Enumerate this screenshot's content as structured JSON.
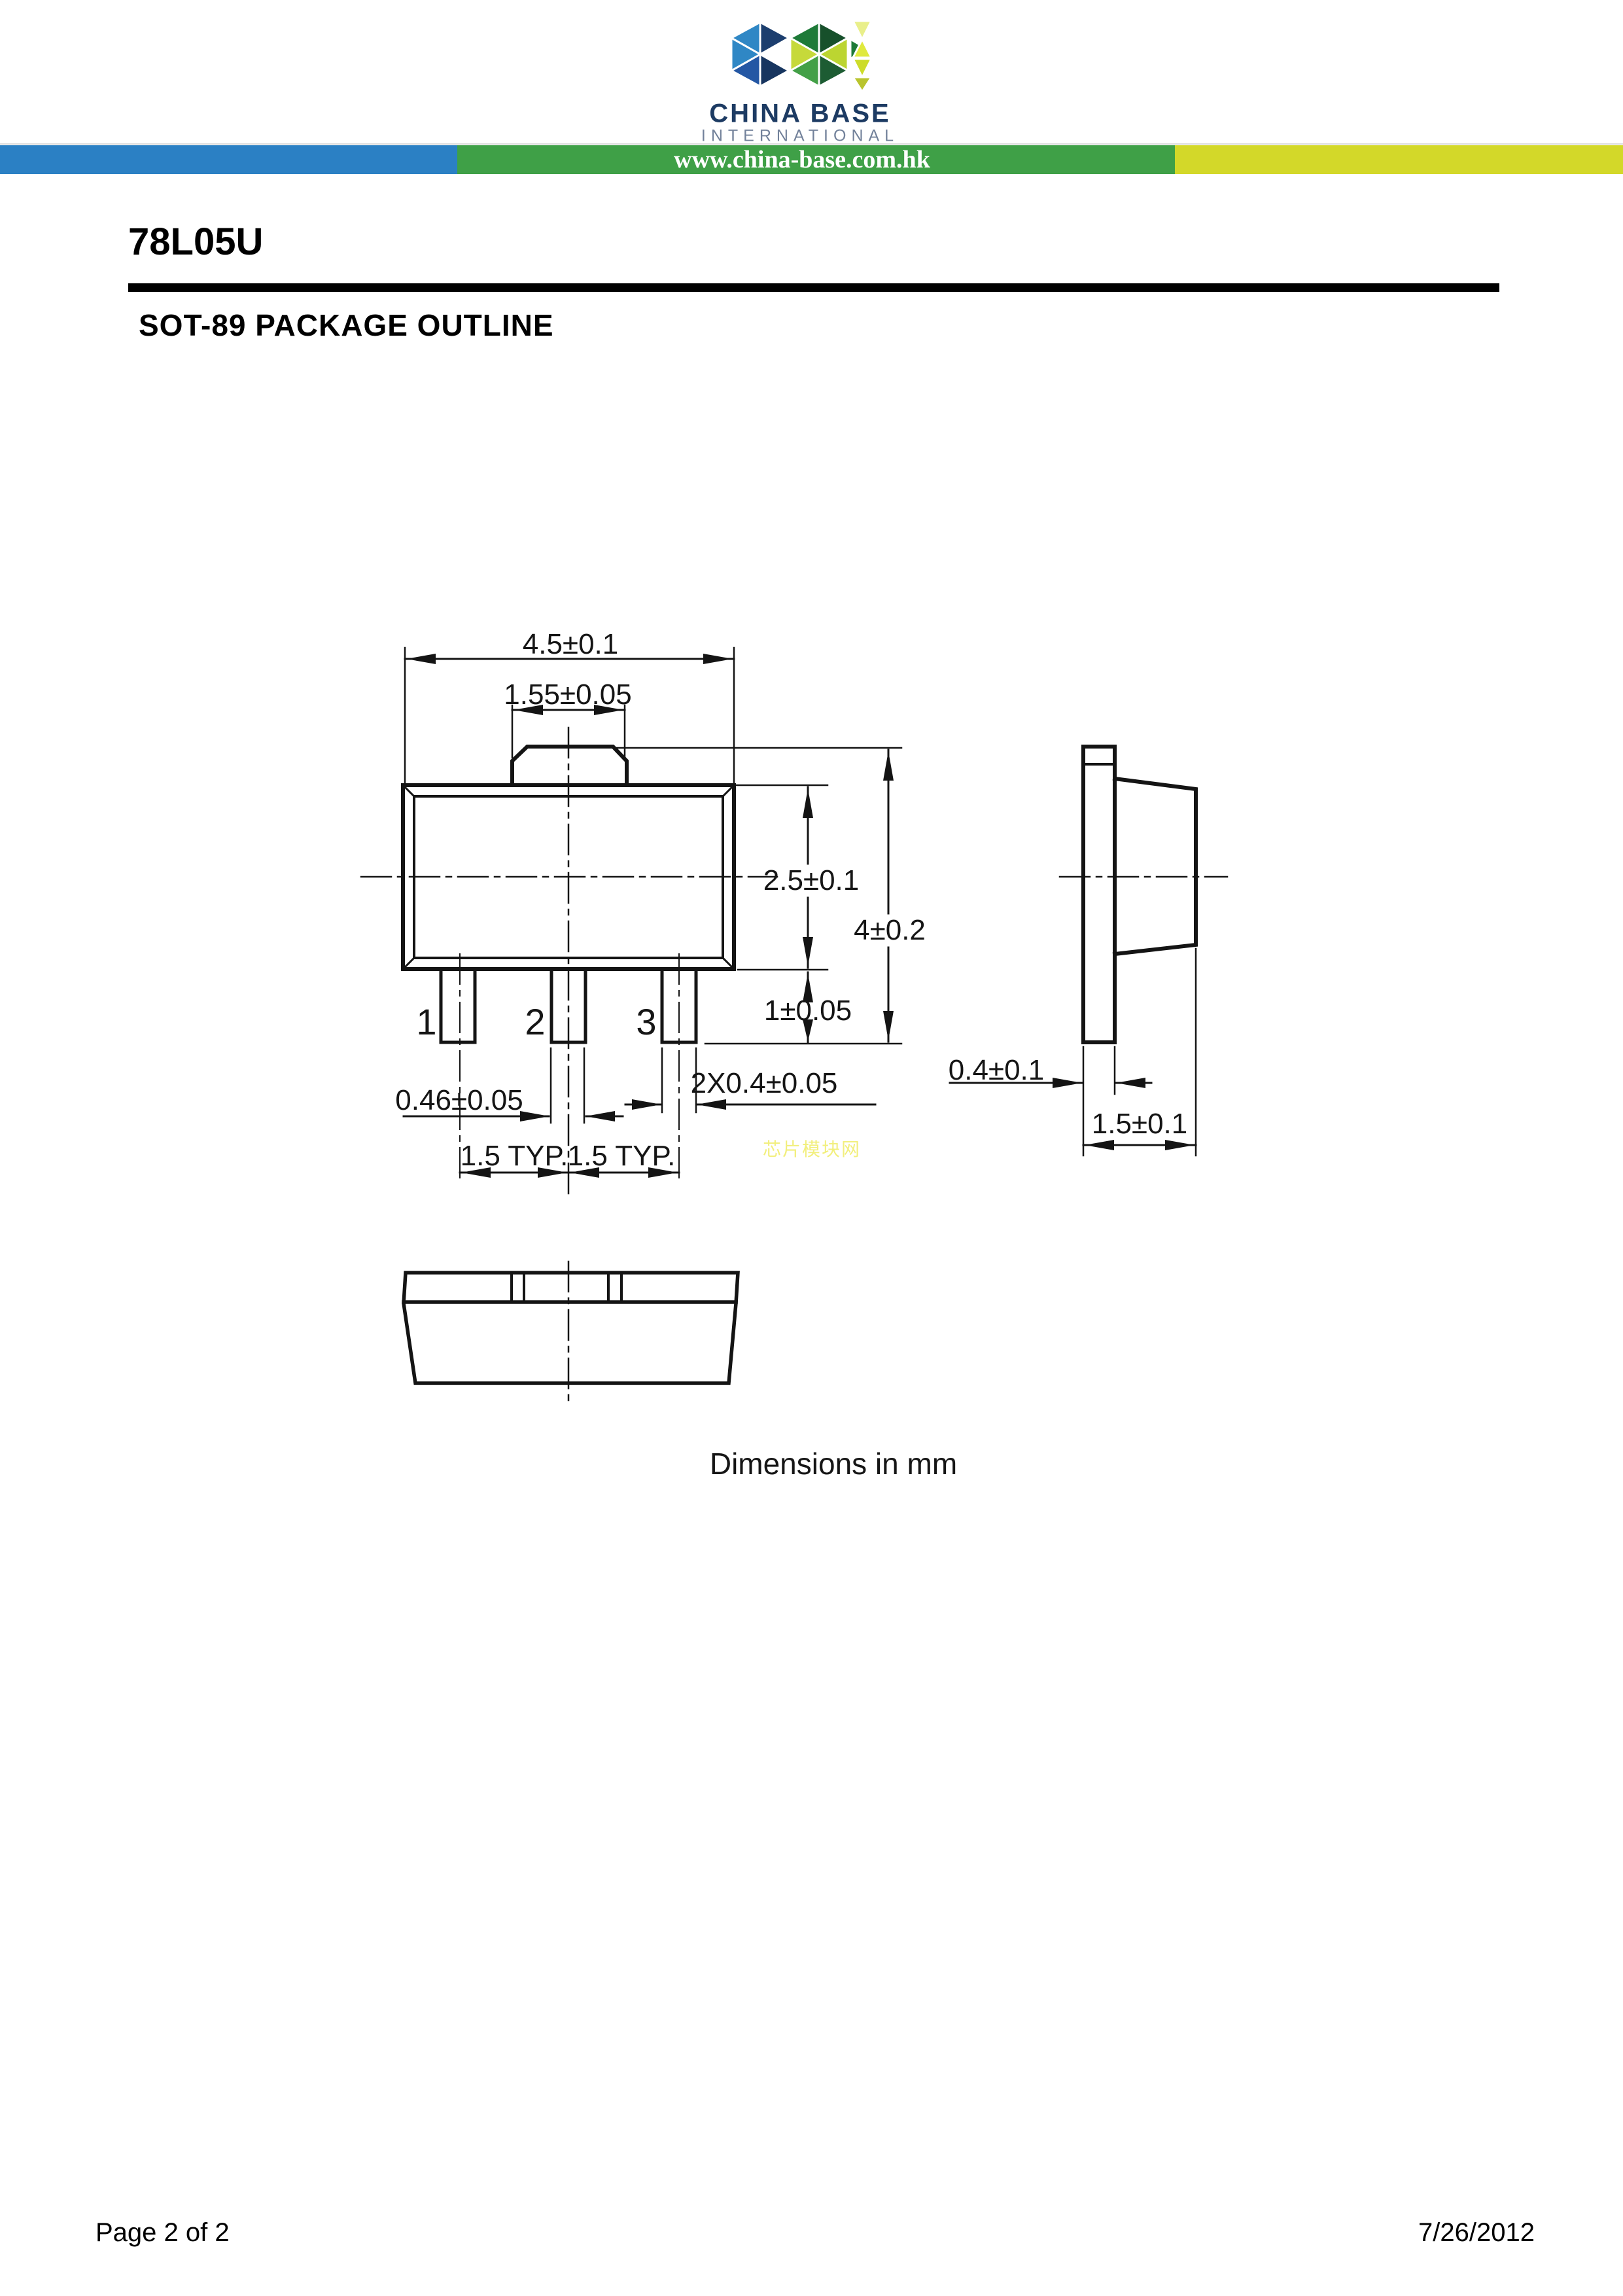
{
  "header": {
    "logo_letters": "CBI",
    "brand_line1": "CHINA BASE",
    "brand_line2": "INTERNATIONAL",
    "website": "www.china-base.com.hk",
    "colors": {
      "bar_blue": "#2b80c4",
      "bar_green": "#3fa047",
      "bar_yellow": "#d3d829",
      "brand_navy": "#1d3b63",
      "brand_gray": "#72819a"
    }
  },
  "title": {
    "part_number": "78L05U",
    "section_heading": "SOT-89 PACKAGE OUTLINE"
  },
  "drawing": {
    "pin_labels": [
      "1",
      "2",
      "3"
    ],
    "dims": {
      "body_width": "4.5±0.1",
      "tab_width": "1.55±0.05",
      "body_height": "2.5±0.1",
      "overall_height": "4±0.2",
      "lead_length": "1±0.05",
      "center_lead_width": "0.46±0.05",
      "outer_lead_width": "2X0.4±0.05",
      "lead_pitch_a": "1.5 TYP.",
      "lead_pitch_b": "1.5 TYP.",
      "tab_thickness": "0.4±0.1",
      "body_thickness": "1.5±0.1"
    },
    "note": "Dimensions in mm",
    "watermark": "芯片模块网"
  },
  "footer": {
    "page": "Page 2 of 2",
    "date": "7/26/2012"
  }
}
